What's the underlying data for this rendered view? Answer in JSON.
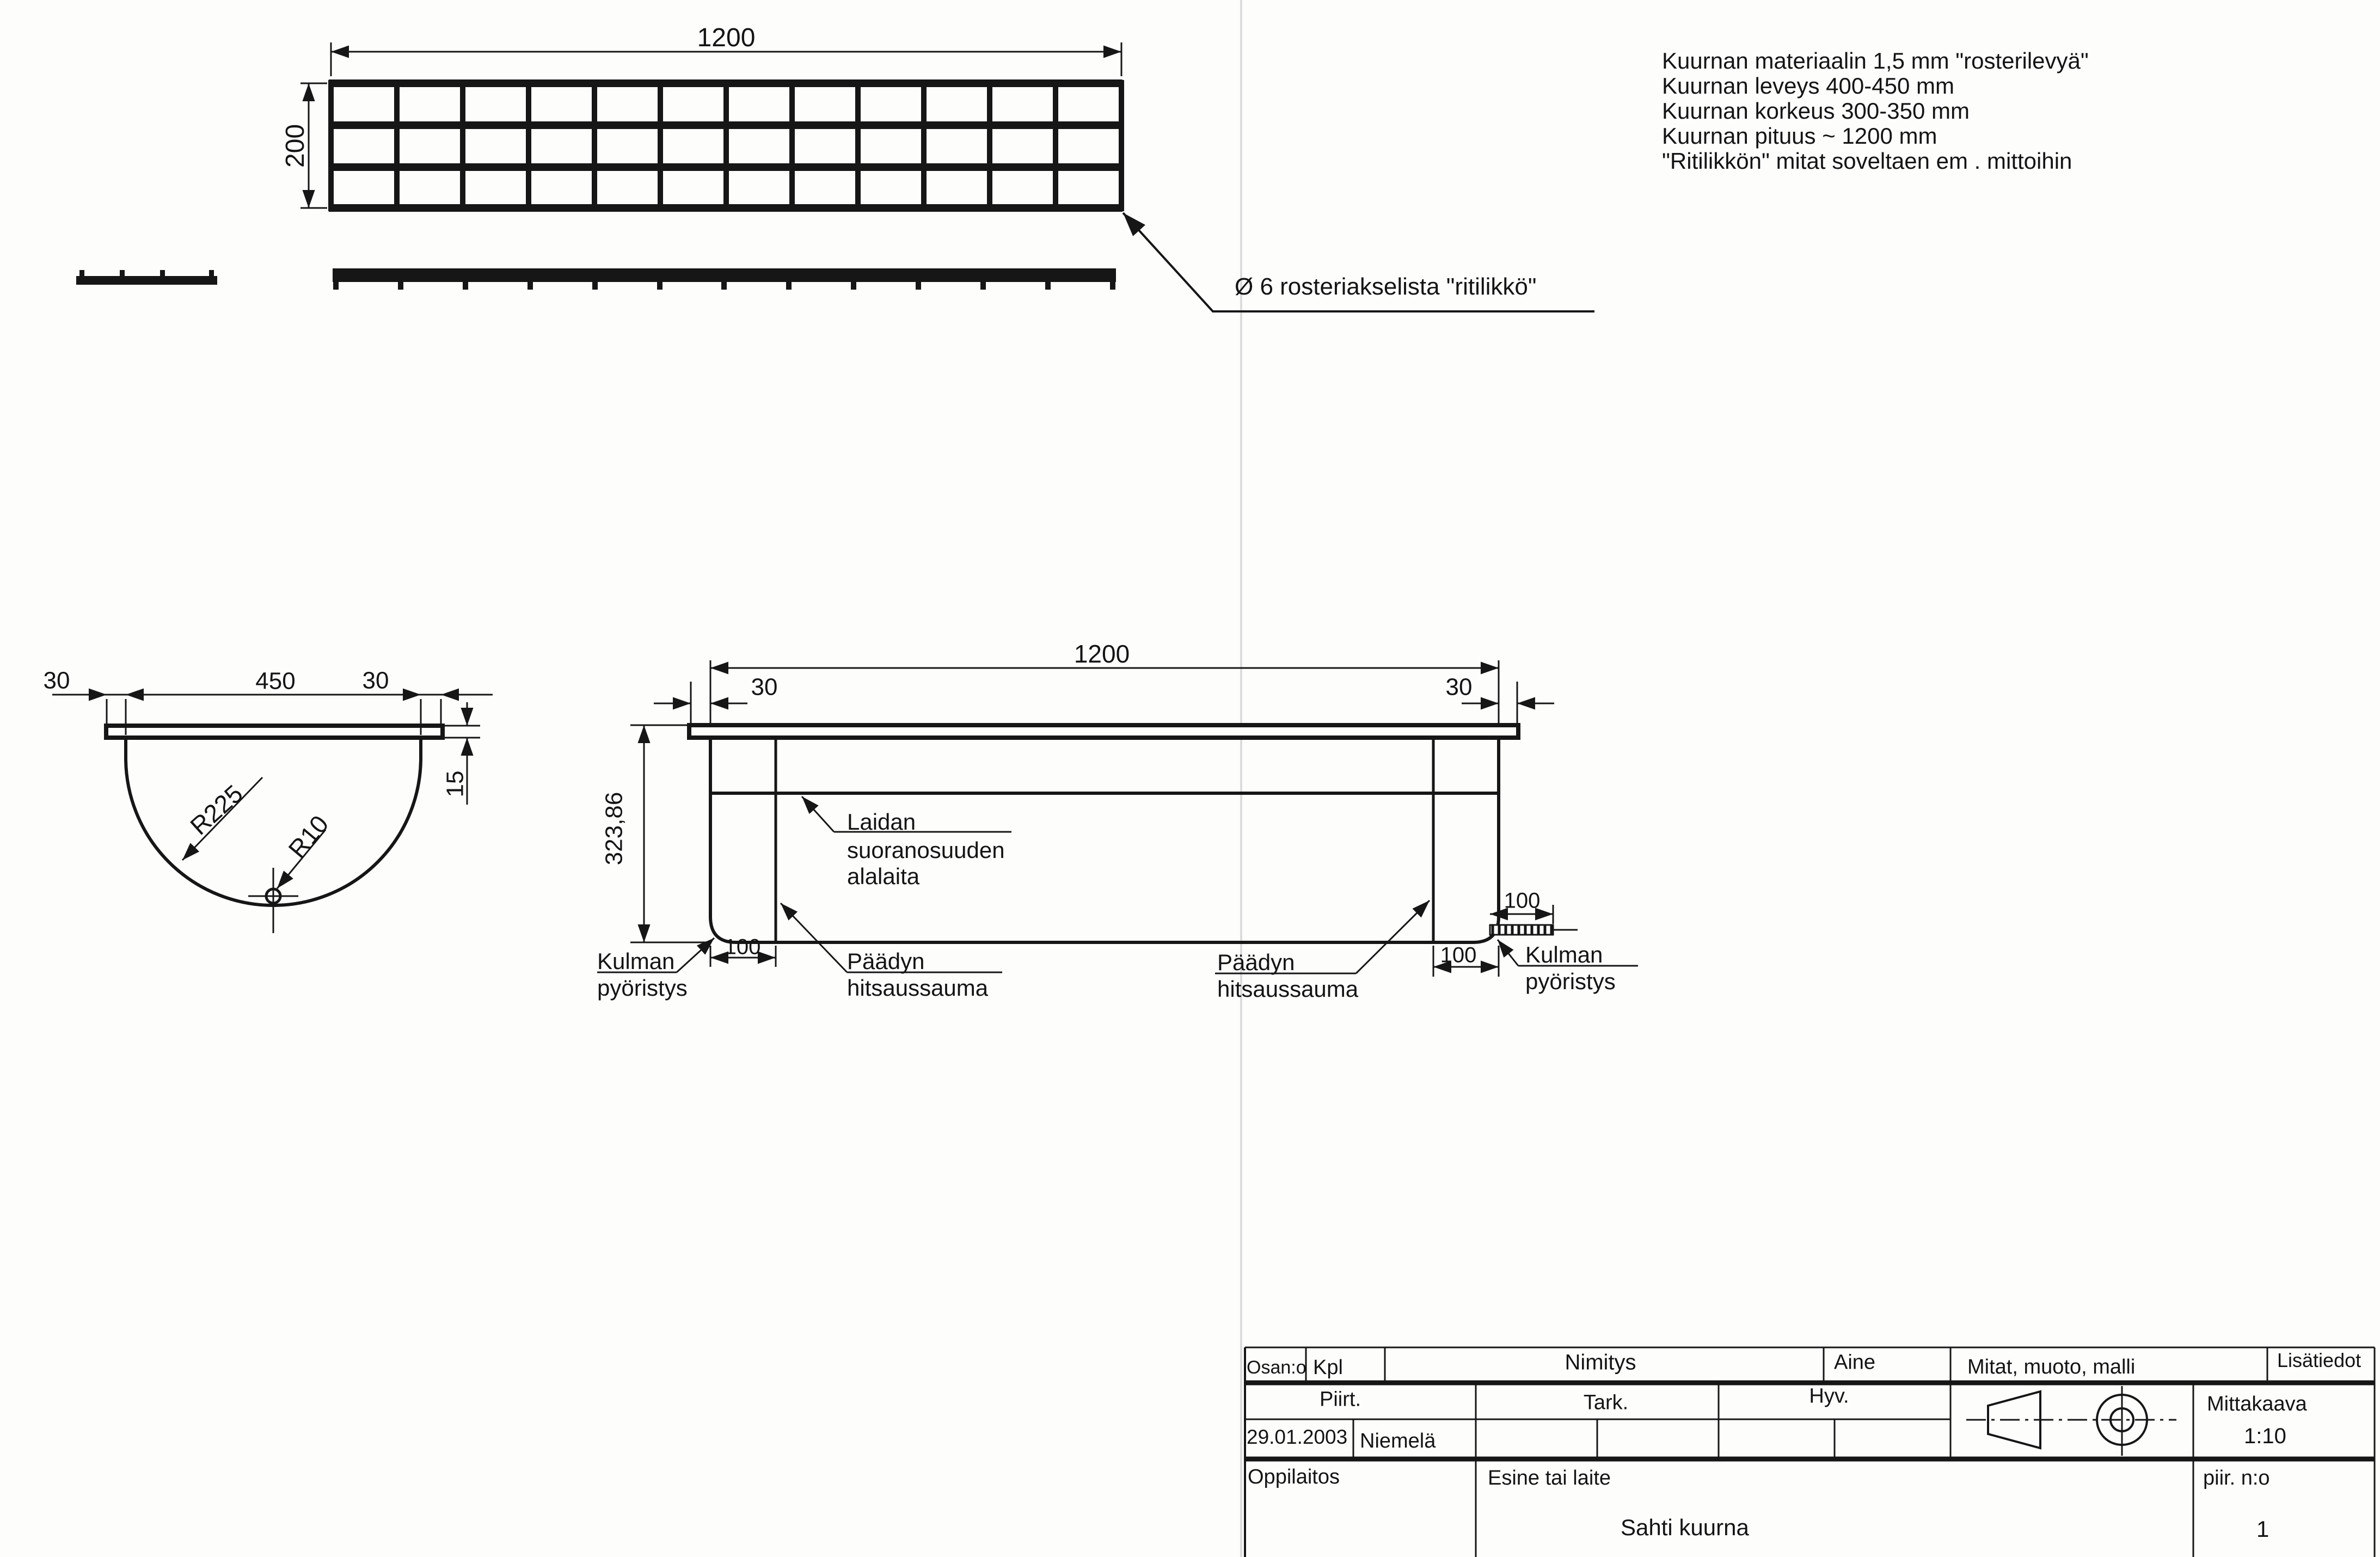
{
  "notes": {
    "lines": [
      "Kuurnan materiaalin 1,5 mm \"rosterilevyä\"",
      "Kuurnan leveys 400-450 mm",
      "Kuurnan korkeus 300-350 mm",
      "Kuurnan pituus ~ 1200 mm",
      "\"Ritilikkön\" mitat soveltaen em . mittoihin"
    ]
  },
  "grate_view": {
    "dim_length": "1200",
    "dim_width": "200",
    "callout": "Ø 6 rosteriakselista \"ritilikkö\""
  },
  "cross_section": {
    "dim_overhang_left": "30",
    "dim_inner_width": "450",
    "dim_overhang_right": "30",
    "dim_rim_height": "15",
    "radius_main": "R225",
    "radius_bottom": "R10"
  },
  "side_view": {
    "dim_length": "1200",
    "dim_overhang_left": "30",
    "dim_overhang_right": "30",
    "dim_height": "323,86",
    "dim_weld_left": "100",
    "dim_weld_right": "100",
    "dim_corner_flat": "100",
    "edge_label": [
      "Laidan",
      "suoranosuuden",
      "alalaita"
    ],
    "corner_left_label": [
      "Kulman",
      "pyöristys"
    ],
    "corner_right_label": [
      "Kulman",
      "pyöristys"
    ],
    "weld_left_label": [
      "Päädyn",
      "hitsaussauma"
    ],
    "weld_right_label": [
      "Päädyn",
      "hitsaussauma"
    ]
  },
  "title_block": {
    "osan_o": "Osan:o",
    "kpl": "Kpl",
    "nimitys": "Nimitys",
    "aine": "Aine",
    "mitat": "Mitat, muoto, malli",
    "lisatiedot": "Lisätiedot",
    "piirt": "Piirt.",
    "tark": "Tark.",
    "hyv": "Hyv.",
    "date": "29.01.2003",
    "drawn_by": "Niemelä",
    "mittakaava": "Mittakaava",
    "scale_value": "1:10",
    "oppilaitos": "Oppilaitos",
    "esine": "Esine tai laite",
    "title": "Sahti kuurna",
    "piir_no": "piir. n:o",
    "sheet_no": "1"
  },
  "colors": {
    "line": "#161616",
    "fold": "#dcdcdc",
    "paper": "#fdfdfc"
  }
}
